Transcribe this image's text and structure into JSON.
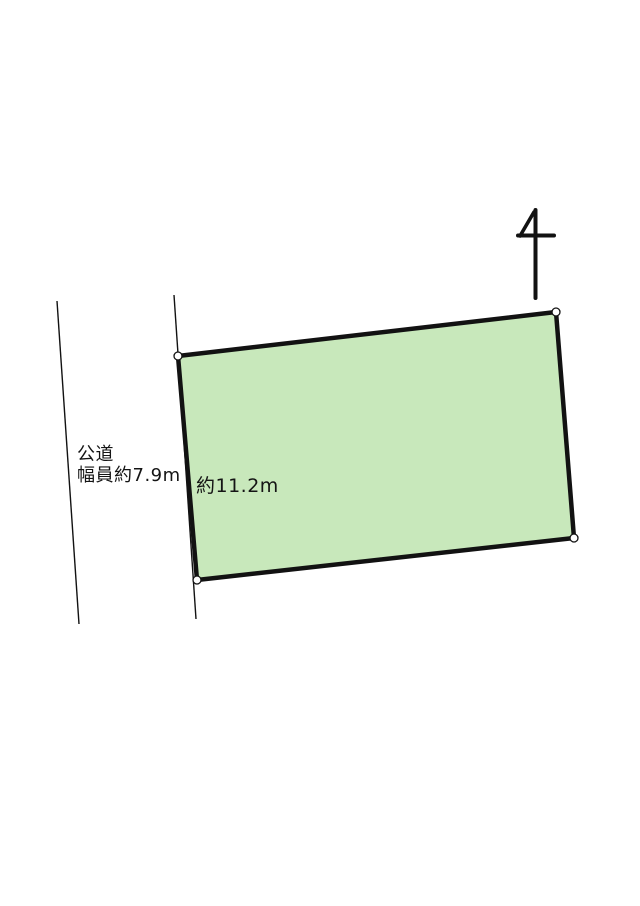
{
  "page": {
    "background_color": "#ffffff",
    "line_color": "#121212"
  },
  "road": {
    "label_line1": "公道",
    "label_line2": "幅員約7.9m"
  },
  "parcel": {
    "frontage_label": "約11.2m",
    "fill_color": "#c8e8bb",
    "stroke_color": "#121212"
  }
}
